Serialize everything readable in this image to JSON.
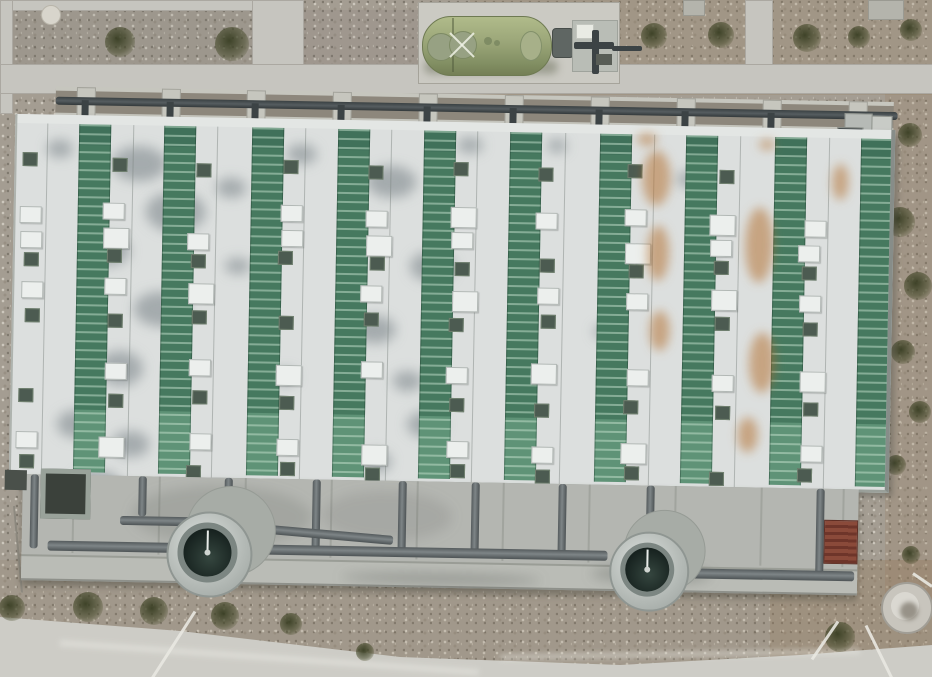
{
  "scene": {
    "width": 932,
    "height": 677,
    "description": "aerial top-down view of striped treatment facility building with green tank, pipe rack, apron pipework and two blowers"
  },
  "palette": {
    "gravel": "#a49d92",
    "gravel_dark": "#8d877c",
    "path": "#c6c5bf",
    "pad": "#cbcac3",
    "panel": "#dcdfde",
    "panel_cap": "#e3e6e4",
    "green_dark": "#40715a",
    "green": "#46795f",
    "green_line": "rgba(196,224,204,0.5)",
    "green_bright": "#5f9377",
    "mark_dark": "#4c5b51",
    "mark_dark_border": "#70806f",
    "hatch": "#ecefed",
    "hatch_border": "#b2b8b5",
    "pipe": "#6e7476",
    "pipe_dark": "#3c4345",
    "concrete": "#c6c6be",
    "apron": "#b4b6b1",
    "apron_low": "#babcb6",
    "apron_edge": "#8e908a",
    "blower_ring": "#7c8682",
    "blower_inner": "#17221f",
    "tank": "#9aa578",
    "grate": "#8a4a3a",
    "grate_line": "#6e352a",
    "road": "#cdccc6",
    "white_line": "#e9e8e1",
    "stain_grey": "rgba(110,120,126,0.5)",
    "rust": "rgba(178,106,38,0.5)"
  },
  "ground": {
    "overlays": [
      [
        470,
        0,
        462,
        95,
        "rgba(151,124,92,0.20)"
      ],
      [
        885,
        90,
        47,
        510,
        "rgba(151,124,92,0.22)"
      ],
      [
        0,
        560,
        932,
        117,
        "rgba(146,125,98,0.15)"
      ],
      [
        770,
        560,
        162,
        117,
        "rgba(151,124,92,0.25)"
      ],
      [
        0,
        0,
        255,
        90,
        "rgba(118,118,116,0.15)"
      ],
      [
        300,
        10,
        120,
        70,
        "rgba(120,118,112,0.12)"
      ]
    ],
    "paths": [
      {
        "name": "path-top-left-horizontal",
        "r": [
          0,
          0,
          255,
          9
        ]
      },
      {
        "name": "path-left-edge",
        "r": [
          0,
          0,
          11,
          112
        ]
      },
      {
        "name": "path-vertical-topleft",
        "r": [
          252,
          0,
          50,
          88
        ]
      },
      {
        "name": "path-vertical-topright",
        "r": [
          745,
          0,
          26,
          84
        ]
      },
      {
        "name": "path-main-horizontal",
        "r": [
          0,
          64,
          932,
          28
        ]
      }
    ],
    "blocks": [
      [
        683,
        0,
        20,
        14
      ],
      [
        868,
        0,
        34,
        18
      ]
    ],
    "rock": [
      50,
      14,
      9
    ],
    "cable": [
      14,
      505,
      22,
      592
    ]
  },
  "bushes": [
    [
      120,
      42,
      15
    ],
    [
      232,
      44,
      17
    ],
    [
      654,
      36,
      13
    ],
    [
      721,
      35,
      13
    ],
    [
      807,
      38,
      14
    ],
    [
      859,
      37,
      11
    ],
    [
      911,
      30,
      11
    ],
    [
      910,
      135,
      12
    ],
    [
      900,
      222,
      15
    ],
    [
      918,
      286,
      14
    ],
    [
      903,
      352,
      12
    ],
    [
      920,
      412,
      11
    ],
    [
      896,
      465,
      10
    ],
    [
      12,
      608,
      13
    ],
    [
      88,
      607,
      15
    ],
    [
      154,
      611,
      14
    ],
    [
      225,
      616,
      14
    ],
    [
      291,
      624,
      11
    ],
    [
      365,
      652,
      9
    ],
    [
      840,
      637,
      15
    ],
    [
      911,
      555,
      9
    ]
  ],
  "tank": {
    "pad": [
      418,
      2,
      200,
      80
    ],
    "body": [
      422,
      16,
      128,
      58
    ],
    "seam_x": 452,
    "plates": [
      [
        440,
        46,
        13
      ],
      [
        462,
        44,
        13
      ]
    ],
    "nubs": [
      [
        488,
        41,
        4
      ],
      [
        497,
        43,
        3
      ]
    ],
    "right_plate": [
      520,
      31,
      20,
      28
    ],
    "motor": [
      552,
      28,
      20,
      28
    ],
    "skid": [
      572,
      20,
      44,
      50
    ],
    "white_box": [
      576,
      24,
      16,
      13
    ],
    "pipes": [
      [
        574,
        42,
        40,
        7
      ],
      [
        592,
        30,
        7,
        44
      ],
      [
        612,
        46,
        30,
        5
      ]
    ],
    "box2": [
      596,
      54,
      16,
      11
    ]
  },
  "facility": {
    "top": 86,
    "rotation": 1.05,
    "rack": {
      "band": [
        56,
        2,
        838,
        27
      ],
      "edges": [
        [
          56,
          0,
          838,
          4
        ],
        [
          56,
          26,
          838,
          5
        ]
      ],
      "posts_x": [
        77,
        162,
        247,
        333,
        419,
        505,
        591,
        677,
        763,
        849
      ],
      "post_w": 17,
      "post_h": 31,
      "pipe": [
        56,
        10,
        842,
        8
      ],
      "drop": [
        5,
        13,
        7,
        20
      ],
      "equipment": [
        [
          845,
          12,
          26,
          17
        ],
        [
          872,
          14,
          19,
          14
        ],
        [
          838,
          26,
          24,
          7
        ]
      ]
    },
    "building": {
      "rect": [
        16,
        28,
        874,
        360
      ],
      "cap_h": 9,
      "stripes_x": [
        62,
        147,
        235,
        321,
        407,
        493,
        583,
        669,
        758,
        844
      ],
      "stripe_w": 30,
      "seams_x": [
        30,
        116,
        200,
        288,
        374,
        460,
        548,
        637,
        723,
        812
      ],
      "mark_cols_x": [
        6,
        90,
        175,
        263,
        349,
        435,
        521,
        611,
        697,
        786
      ],
      "mark_rows": [
        [
          42,
          "d"
        ],
        [
          88,
          "w"
        ],
        [
          114,
          "w"
        ],
        [
          136,
          "d"
        ],
        [
          166,
          "w"
        ],
        [
          194,
          "d"
        ],
        [
          244,
          "w"
        ],
        [
          276,
          "d"
        ],
        [
          320,
          "w"
        ],
        [
          344,
          "d"
        ]
      ],
      "grey_stains": [
        [
          95,
          30,
          55,
          35
        ],
        [
          130,
          75,
          60,
          40
        ],
        [
          70,
          120,
          45,
          30
        ],
        [
          120,
          175,
          55,
          35
        ],
        [
          85,
          235,
          45,
          35
        ],
        [
          45,
          295,
          40,
          28
        ],
        [
          100,
          315,
          38,
          26
        ],
        [
          60,
          355,
          50,
          28
        ],
        [
          350,
          45,
          50,
          32
        ],
        [
          395,
          130,
          45,
          30
        ],
        [
          340,
          195,
          42,
          28
        ],
        [
          395,
          290,
          38,
          26
        ],
        [
          350,
          330,
          30,
          22
        ],
        [
          270,
          25,
          30,
          20
        ],
        [
          30,
          25,
          26,
          18
        ],
        [
          440,
          15,
          26,
          16
        ],
        [
          200,
          60,
          30,
          20
        ],
        [
          210,
          140,
          26,
          16
        ],
        [
          530,
          15,
          20,
          14
        ],
        [
          660,
          45,
          26,
          16
        ],
        [
          680,
          130,
          22,
          14
        ],
        [
          580,
          200,
          20,
          14
        ],
        [
          260,
          250,
          24,
          16
        ],
        [
          380,
          250,
          30,
          20
        ]
      ],
      "rust_stains": [
        [
          626,
          25,
          28,
          55
        ],
        [
          632,
          100,
          22,
          55
        ],
        [
          636,
          185,
          20,
          40
        ],
        [
          730,
          80,
          28,
          75
        ],
        [
          736,
          205,
          26,
          60
        ],
        [
          726,
          290,
          20,
          35
        ],
        [
          816,
          35,
          16,
          36
        ],
        [
          620,
          8,
          20,
          12
        ],
        [
          742,
          12,
          16,
          10
        ]
      ]
    },
    "apron": {
      "rect": [
        30,
        388,
        836,
        102
      ],
      "joints_x": [
        80,
        166,
        252,
        338,
        424,
        510,
        596,
        682,
        768,
        850
      ],
      "walk_strip": [
        30,
        468,
        836,
        22
      ],
      "pit_a": [
        48,
        382,
        40,
        40
      ],
      "pit_b": [
        12,
        384,
        22,
        20
      ],
      "pipes": [
        [
          38,
          388,
          8,
          74
        ],
        [
          146,
          388,
          8,
          40
        ],
        [
          128,
          428,
          74,
          9
        ],
        [
          232,
          388,
          8,
          38
        ],
        [
          320,
          388,
          8,
          74
        ],
        [
          406,
          388,
          8,
          74
        ],
        [
          479,
          388,
          8,
          74
        ],
        [
          566,
          388,
          8,
          74
        ],
        [
          654,
          388,
          8,
          48
        ],
        [
          824,
          388,
          8,
          88
        ],
        [
          56,
          454,
          560,
          10
        ],
        [
          244,
          432,
          158,
          9,
          4
        ],
        [
          695,
          470,
          168,
          10
        ]
      ],
      "smudges": [
        [
          140,
          396,
          180,
          60,
          "rgba(85,90,85,0.18)"
        ],
        [
          330,
          398,
          130,
          50,
          "rgba(85,90,85,0.15)"
        ],
        [
          600,
          468,
          120,
          18,
          "rgba(60,62,58,0.25)"
        ],
        [
          350,
          480,
          200,
          10,
          "rgba(60,62,58,0.30)"
        ]
      ],
      "pads": [
        [
          238,
          440,
          44
        ],
        [
          672,
          452,
          40
        ]
      ],
      "blowers": [
        [
          216,
          463,
          41
        ],
        [
          656,
          472,
          38
        ]
      ],
      "grate": [
        832,
        419,
        32,
        42
      ]
    }
  },
  "road": {
    "rect": [
      0,
      595,
      932,
      82
    ],
    "clip": "polygon(0px 22px, 180px 36px, 400px 62px, 620px 70px, 800px 60px, 932px 50px, 932px 82px, 0px 82px)",
    "streaks": [
      [
        60,
        640,
        420,
        6,
        4
      ],
      [
        500,
        655,
        360,
        5,
        -1
      ]
    ]
  },
  "manhole": {
    "cx": 905,
    "cy": 606,
    "r": 24
  },
  "white_lines": [
    [
      195,
      610,
      152,
      677
    ],
    [
      838,
      620,
      812,
      658
    ],
    [
      866,
      624,
      892,
      677
    ],
    [
      913,
      572,
      932,
      585
    ]
  ]
}
